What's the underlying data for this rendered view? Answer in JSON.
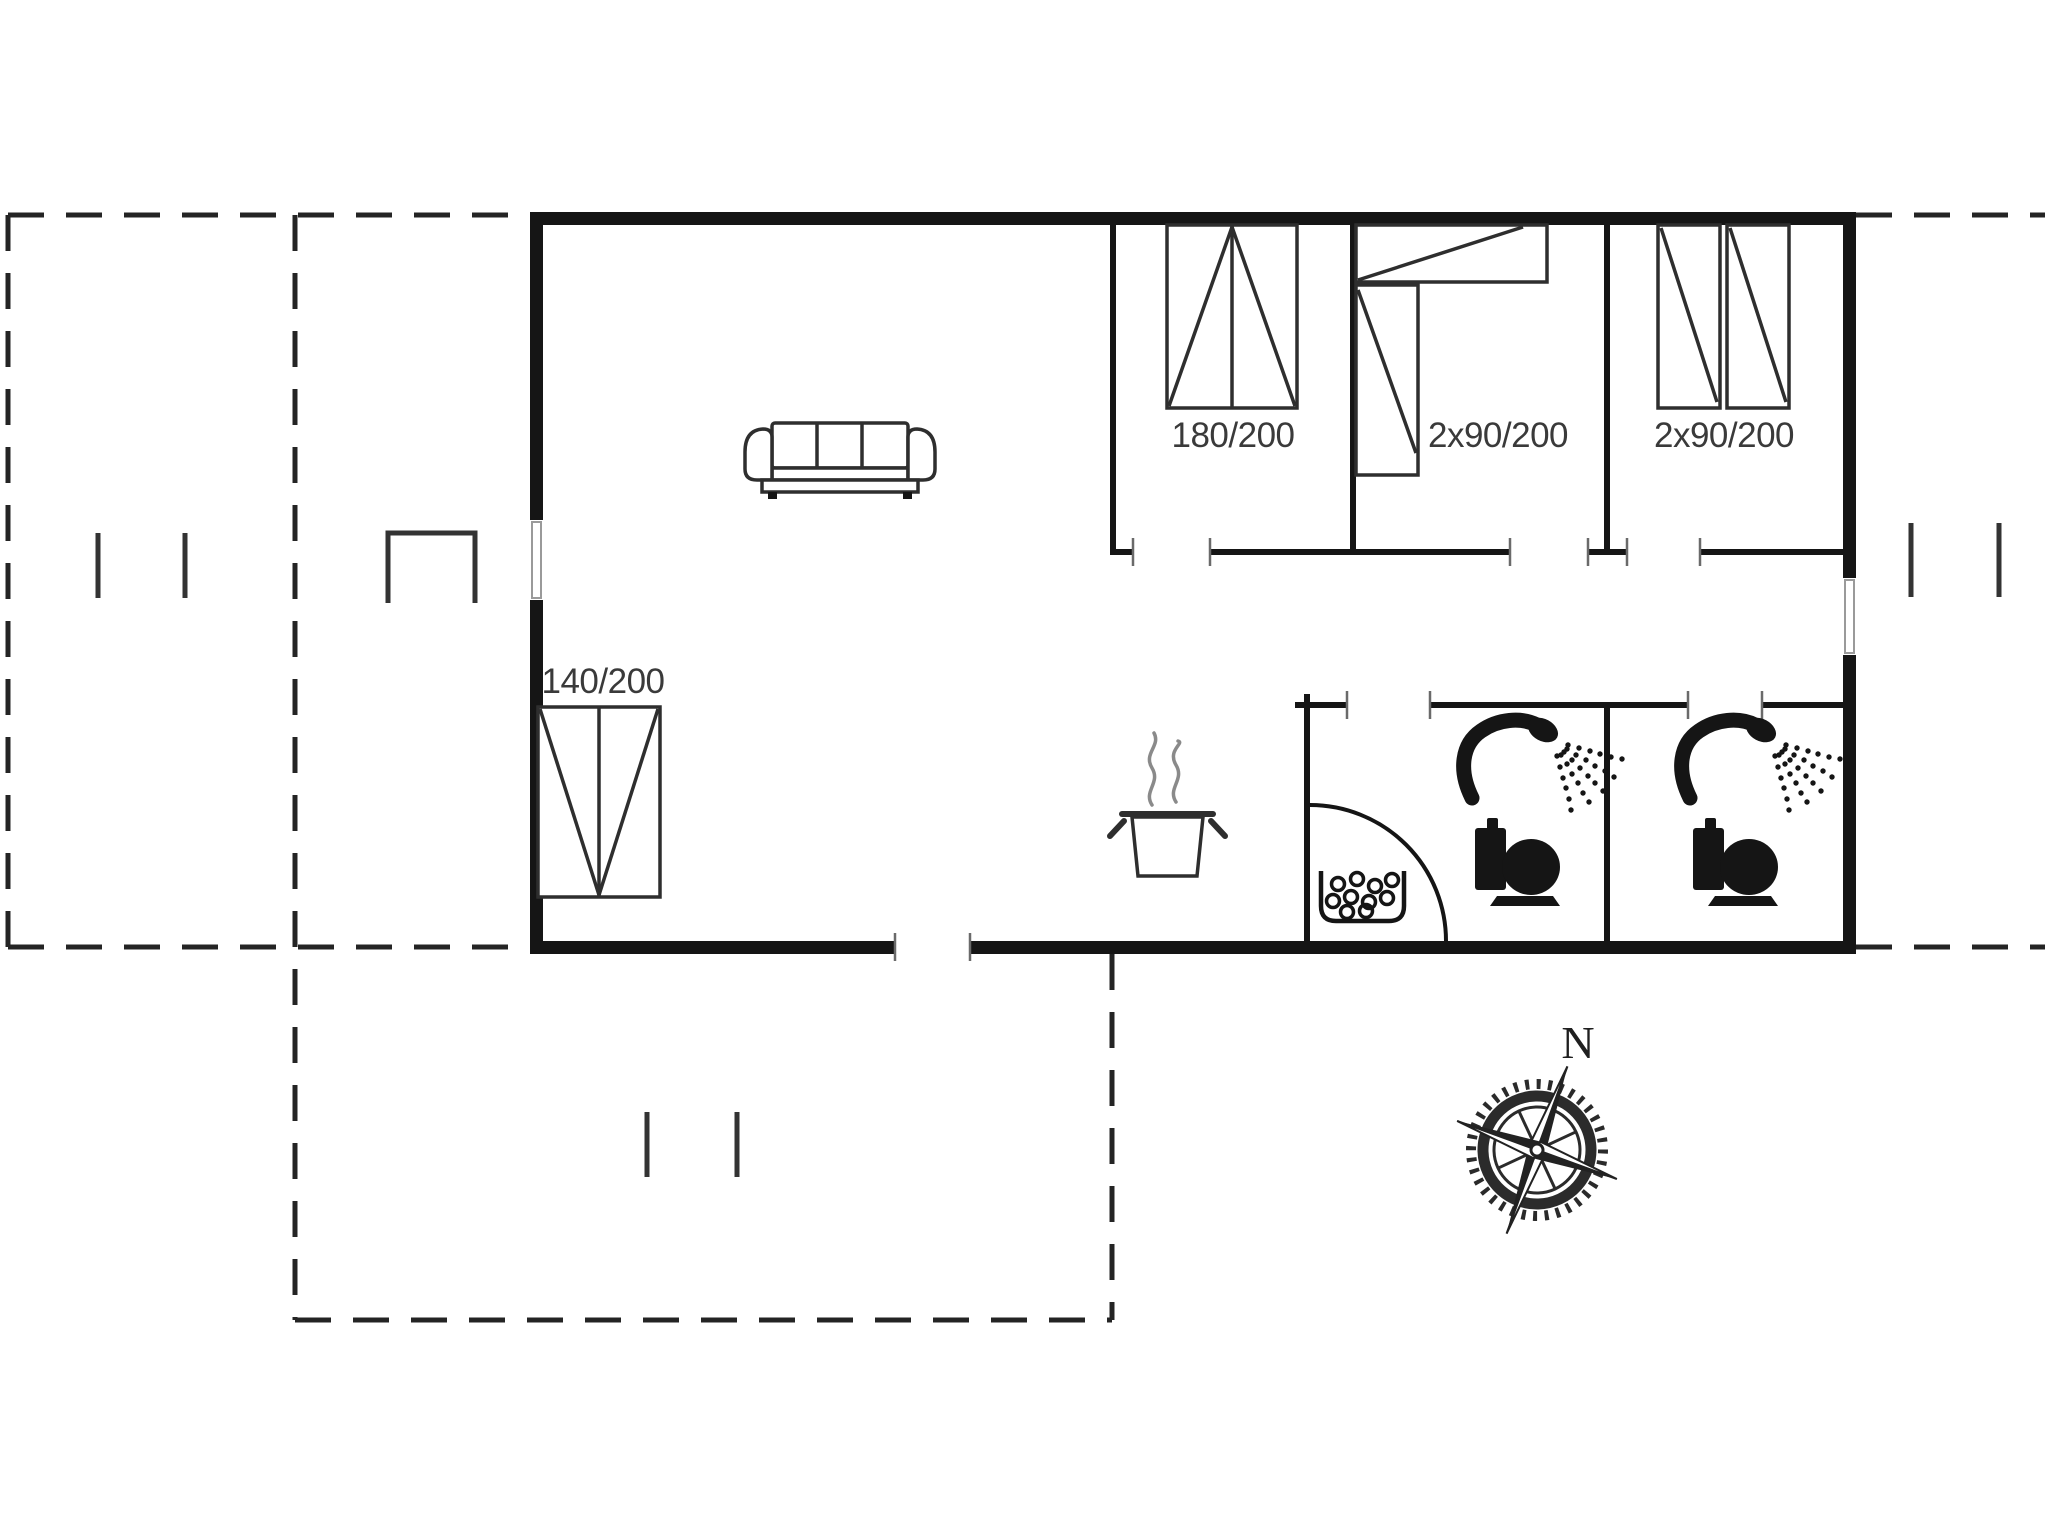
{
  "colors": {
    "background": "#ffffff",
    "wall": "#151515",
    "furniture_line": "#2e2e2e",
    "dashed_line": "#242424",
    "text": "#3a3a3a"
  },
  "labels": {
    "bedroom1_bed": "180/200",
    "bedroom2_bed": "2x90/200",
    "bedroom3_bed": "2x90/200",
    "living_bed": "140/200",
    "compass_north": "N"
  },
  "icons": [
    "sofa-icon",
    "double-bed-180-icon",
    "bunk-bed-icon",
    "twin-beds-icon",
    "double-bed-140-icon",
    "cooking-pot-icon",
    "steam-icon",
    "washbasin-icon",
    "door-swing-arc",
    "shower-icon",
    "toilet-icon",
    "compass-rose-icon",
    "grill-symbol"
  ]
}
